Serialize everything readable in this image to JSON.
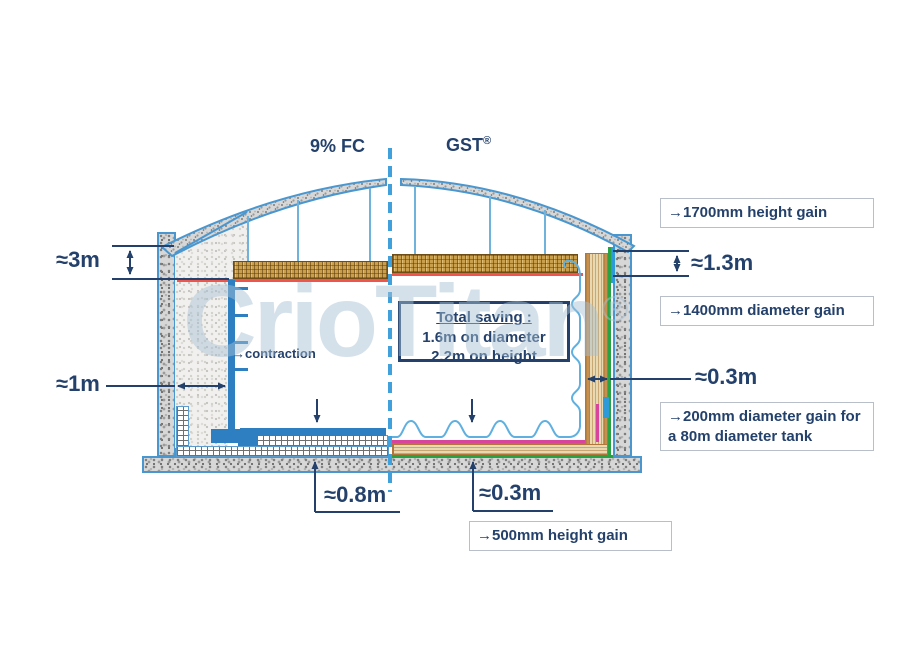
{
  "labels": {
    "fc": "9% FC",
    "gst": "GST",
    "gst_reg": "®",
    "contraction": "→contraction"
  },
  "watermark": {
    "text": "CrioTitan",
    "reg": "®"
  },
  "dims": {
    "fc_roof_insulation_height": "≈3m",
    "fc_wall_insulation_width": "≈1m",
    "gst_height_gain": "≈1.3m",
    "gst_wall_insulation_width": "≈0.3m",
    "fc_floor_insulation_height": "≈0.8m",
    "gst_floor_insulation_height": "≈0.3m"
  },
  "total_saving": {
    "title": "Total saving :",
    "diameter": "1.6m on diameter",
    "height": "2.2m on height"
  },
  "callouts": {
    "height_gain_top": "→1700mm height gain",
    "diameter_gain": "→1400mm diameter gain",
    "diameter_gain_tank": "→200mm diameter gain for a 80m diameter tank",
    "height_gain_bottom": "→500mm height gain"
  },
  "colors": {
    "navy": "#24416b",
    "tank_blue": "#2d7fc1",
    "membrane_blue": "#5fb0e0",
    "dashed_blue": "#3fa0dc",
    "red_liner": "#f0554d",
    "green_barrier": "#27a344",
    "magenta_pipe": "#d8449c",
    "deck_gold": "#c99f4e",
    "insulation_tan": "#e9d9b2"
  }
}
